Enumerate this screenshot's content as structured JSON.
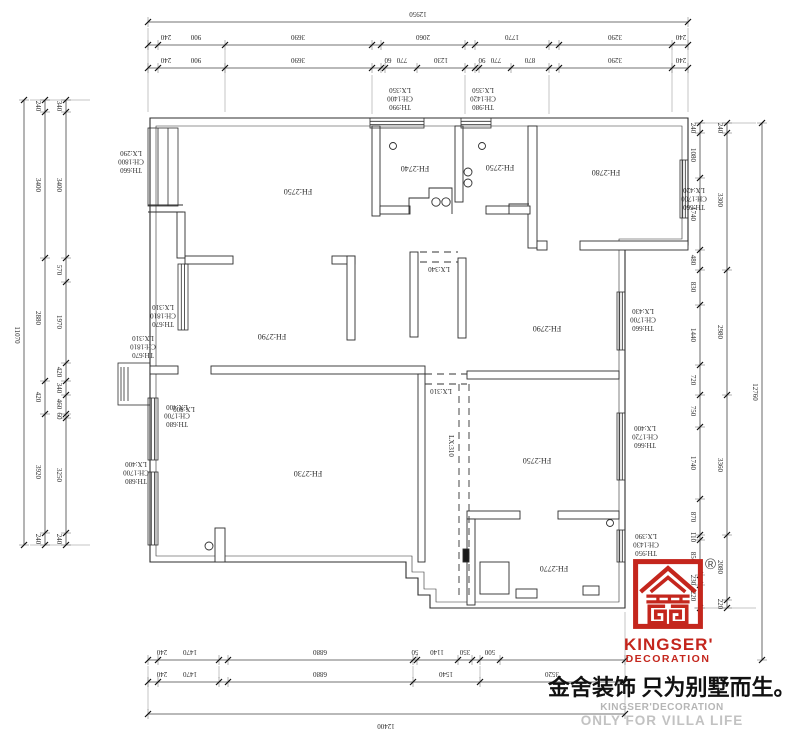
{
  "meta": {
    "background": "#ffffff",
    "line_color": "#2e2e2e",
    "accent_red": "#c4261d",
    "gray_text": "#bdbdbd"
  },
  "plan": {
    "rooms": [
      {
        "label": "FH:2750",
        "x": 298,
        "y": 186
      },
      {
        "label": "FH:2740",
        "x": 415,
        "y": 163
      },
      {
        "label": "FH:2750",
        "x": 500,
        "y": 162
      },
      {
        "label": "FH:2780",
        "x": 606,
        "y": 167
      },
      {
        "label": "FH:2790",
        "x": 272,
        "y": 331
      },
      {
        "label": "FH:2790",
        "x": 547,
        "y": 323
      },
      {
        "label": "FH:2730",
        "x": 308,
        "y": 468
      },
      {
        "label": "FH:2750",
        "x": 537,
        "y": 455
      },
      {
        "label": "FH:2770",
        "x": 554,
        "y": 563
      }
    ],
    "window_tags": [
      {
        "lines": [
          "TH:660",
          "CH:1800",
          "LX:290"
        ],
        "x": 131,
        "y": 162
      },
      {
        "lines": [
          "TH:990",
          "CH:1400",
          "LX:350"
        ],
        "x": 400,
        "y": 99
      },
      {
        "lines": [
          "TH:980",
          "CH:1420",
          "LX:350"
        ],
        "x": 483,
        "y": 99
      },
      {
        "lines": [
          "TH:660",
          "CH:1700",
          "LX:420"
        ],
        "x": 694,
        "y": 199
      },
      {
        "lines": [
          "TH:670",
          "CH:1810",
          "LX:310"
        ],
        "x": 163,
        "y": 316
      },
      {
        "lines": [
          "TH:670",
          "CH:1810",
          "LX:310"
        ],
        "x": 143,
        "y": 347
      },
      {
        "lines": [
          "TH:680",
          "CH:1700",
          "LX:400"
        ],
        "x": 177,
        "y": 416
      },
      {
        "lines": [
          "TH:680",
          "CH:1700",
          "LX:400"
        ],
        "x": 136,
        "y": 473
      },
      {
        "lines": [
          "TH:660",
          "CH:1700",
          "LX:430"
        ],
        "x": 643,
        "y": 320
      },
      {
        "lines": [
          "TH:660",
          "CH:1720",
          "LX:400"
        ],
        "x": 645,
        "y": 437
      },
      {
        "lines": [
          "TH:950",
          "CH:1430",
          "LX:390"
        ],
        "x": 646,
        "y": 545
      }
    ],
    "openings": [
      {
        "label": "LX:800",
        "x": 184,
        "y": 407,
        "rot": 180
      },
      {
        "label": "LX:340",
        "x": 439,
        "y": 267,
        "rot": 180
      },
      {
        "label": "LX:310",
        "x": 441,
        "y": 389,
        "rot": 180
      },
      {
        "label": "LX:310",
        "x": 449,
        "y": 446,
        "rot": 90
      }
    ]
  },
  "dims": {
    "top": [
      {
        "y": 22,
        "x1": 148,
        "x2": 688,
        "ticks": [
          148,
          688
        ],
        "labels": [
          {
            "t": "12950",
            "x": 418
          }
        ]
      },
      {
        "y": 45,
        "x1": 148,
        "x2": 688,
        "ticks": [
          148,
          158,
          225,
          372,
          381,
          465,
          475,
          549,
          559,
          672,
          688
        ],
        "labels": [
          {
            "t": "240",
            "x": 166
          },
          {
            "t": "900",
            "x": 196
          },
          {
            "t": "3690",
            "x": 298
          },
          {
            "t": "2060",
            "x": 423
          },
          {
            "t": "1770",
            "x": 512
          },
          {
            "t": "3290",
            "x": 615
          },
          {
            "t": "240",
            "x": 681
          }
        ]
      },
      {
        "y": 68,
        "x1": 148,
        "x2": 688,
        "ticks": [
          148,
          158,
          225,
          372,
          381,
          385,
          417,
          465,
          475,
          479,
          511,
          549,
          559,
          672,
          688
        ],
        "labels": [
          {
            "t": "240",
            "x": 166
          },
          {
            "t": "900",
            "x": 196
          },
          {
            "t": "3690",
            "x": 298
          },
          {
            "t": "60",
            "x": 388
          },
          {
            "t": "770",
            "x": 402
          },
          {
            "t": "1230",
            "x": 441
          },
          {
            "t": "90",
            "x": 482
          },
          {
            "t": "770",
            "x": 496
          },
          {
            "t": "870",
            "x": 530
          },
          {
            "t": "3290",
            "x": 615
          },
          {
            "t": "240",
            "x": 681
          }
        ]
      }
    ],
    "bottom": [
      {
        "y": 660,
        "x1": 148,
        "x2": 625,
        "ticks": [
          148,
          158,
          219,
          228,
          413,
          417,
          458,
          472,
          480,
          500,
          625
        ],
        "labels": [
          {
            "t": "240",
            "x": 162
          },
          {
            "t": "1470",
            "x": 190
          },
          {
            "t": "6880",
            "x": 320
          },
          {
            "t": "50",
            "x": 415
          },
          {
            "t": "1140",
            "x": 437
          },
          {
            "t": "350",
            "x": 465
          },
          {
            "t": "500",
            "x": 490
          }
        ]
      },
      {
        "y": 682,
        "x1": 148,
        "x2": 625,
        "ticks": [
          148,
          158,
          219,
          228,
          413,
          480,
          625
        ],
        "labels": [
          {
            "t": "240",
            "x": 162
          },
          {
            "t": "1470",
            "x": 190
          },
          {
            "t": "6880",
            "x": 320
          },
          {
            "t": "1540",
            "x": 446
          },
          {
            "t": "3520",
            "x": 552
          }
        ]
      },
      {
        "y": 714,
        "x1": 148,
        "x2": 625,
        "ticks": [
          148,
          625
        ],
        "labels": [
          {
            "t": "12400",
            "x": 386,
            "below": true
          }
        ]
      }
    ],
    "left": [
      {
        "x": 24,
        "y1": 100,
        "y2": 545,
        "ticks": [
          100,
          545
        ],
        "labels": [
          {
            "t": "11070",
            "y": 335
          }
        ]
      },
      {
        "x": 45,
        "y1": 100,
        "y2": 545,
        "ticks": [
          100,
          112,
          258,
          381,
          414,
          533,
          545
        ],
        "labels": [
          {
            "t": "240",
            "y": 106
          },
          {
            "t": "3400",
            "y": 185
          },
          {
            "t": "2880",
            "y": 318
          },
          {
            "t": "420",
            "y": 397
          },
          {
            "t": "3920",
            "y": 472
          },
          {
            "t": "240",
            "y": 539
          }
        ]
      },
      {
        "x": 66,
        "y1": 100,
        "y2": 545,
        "ticks": [
          100,
          112,
          258,
          282,
          363,
          381,
          395,
          414,
          418,
          533,
          545
        ],
        "labels": [
          {
            "t": "340",
            "y": 106
          },
          {
            "t": "3400",
            "y": 185
          },
          {
            "t": "570",
            "y": 270
          },
          {
            "t": "1970",
            "y": 322
          },
          {
            "t": "420",
            "y": 372
          },
          {
            "t": "340",
            "y": 388
          },
          {
            "t": "460",
            "y": 404
          },
          {
            "t": "60",
            "y": 416
          },
          {
            "t": "3250",
            "y": 475
          },
          {
            "t": "240",
            "y": 539
          }
        ]
      }
    ],
    "right": [
      {
        "x": 700,
        "y1": 123,
        "y2": 608,
        "ticks": [
          123,
          133,
          178,
          250,
          270,
          305,
          365,
          395,
          427,
          499,
          535,
          540,
          575,
          585,
          608
        ],
        "labels": [
          {
            "t": "240",
            "y": 128
          },
          {
            "t": "1080",
            "y": 155
          },
          {
            "t": "1740",
            "y": 214
          },
          {
            "t": "480",
            "y": 260
          },
          {
            "t": "830",
            "y": 287
          },
          {
            "t": "1440",
            "y": 335
          },
          {
            "t": "720",
            "y": 380
          },
          {
            "t": "750",
            "y": 411
          },
          {
            "t": "1740",
            "y": 463
          },
          {
            "t": "870",
            "y": 517
          },
          {
            "t": "110",
            "y": 537
          },
          {
            "t": "850",
            "y": 557
          },
          {
            "t": "230",
            "y": 580
          },
          {
            "t": "220",
            "y": 596
          }
        ]
      },
      {
        "x": 727,
        "y1": 123,
        "y2": 608,
        "ticks": [
          123,
          133,
          270,
          395,
          535,
          600,
          608
        ],
        "labels": [
          {
            "t": "240",
            "y": 128
          },
          {
            "t": "3300",
            "y": 200
          },
          {
            "t": "2980",
            "y": 332
          },
          {
            "t": "3360",
            "y": 465
          },
          {
            "t": "2080",
            "y": 567
          },
          {
            "t": "220",
            "y": 604
          }
        ]
      },
      {
        "x": 762,
        "y1": 123,
        "y2": 660,
        "ticks": [
          123,
          660
        ],
        "labels": [
          {
            "t": "12760",
            "y": 392
          }
        ]
      }
    ]
  },
  "brand": {
    "registered": "®",
    "logo_text_1": "KINGSER'",
    "logo_text_2": "DECORATION",
    "slogan_cn": "金舍装饰 只为别墅而生。",
    "sub_en_1": "KINGSER'DECORATION",
    "sub_en_2": "ONLY FOR VILLA LIFE"
  }
}
